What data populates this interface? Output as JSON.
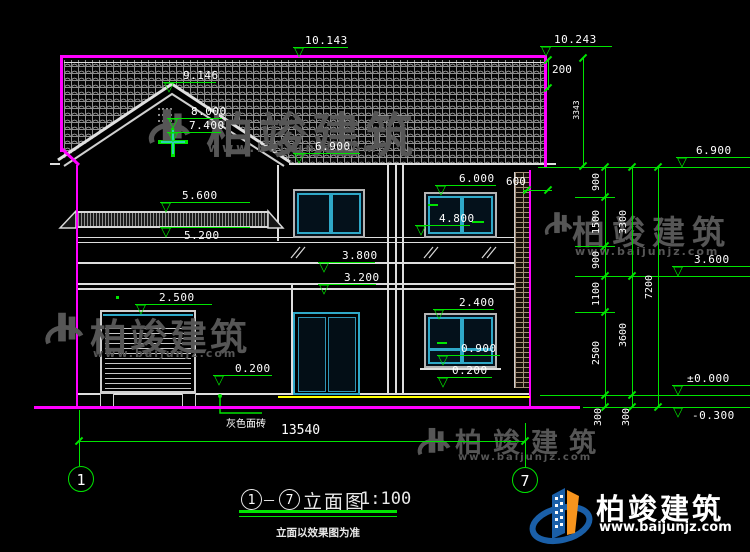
{
  "watermark": {
    "name": "柏竣建筑",
    "url": "www.baijunjz.com"
  },
  "logo": {
    "name": "柏竣建筑",
    "url": "www.baijunjz.com"
  },
  "title": {
    "grid_from": "1",
    "grid_to": "7",
    "separator": "－",
    "name": "立面图",
    "scale": "1:100",
    "note": "立面以效果图为准"
  },
  "grid_bubbles": {
    "left": "1",
    "right": "7"
  },
  "labels": {
    "facade_material": "灰色面砖"
  },
  "symbols": {
    "level_triangle": "▽"
  },
  "levels": {
    "ridge_left": "10.143",
    "ridge_right": "10.243",
    "gable_peak": "9.146",
    "gable_upper": "8.000",
    "gable_cross": "7.400",
    "eave_left": "6.900",
    "eave_right": "6.900",
    "canopy_top": "5.600",
    "canopy_bottom": "5.200",
    "garage_head": "2.500",
    "win2_head": "6.000",
    "win2_sill": "4.800",
    "railing_top": "3.800",
    "floor2": "3.200",
    "win1_head": "2.400",
    "win1_transom": "0.900",
    "win1_sill": "0.200",
    "porch": "0.200",
    "right_3600": "3.600",
    "right_zero": "±0.000",
    "right_minus": "-0.300"
  },
  "dims": {
    "roof_edge": "200",
    "roof_side": "3343",
    "overhang": "600",
    "total_width": "13540",
    "chain_inner": [
      "900",
      "1500",
      "900",
      "1100",
      "2500",
      "300"
    ],
    "chain_mid": [
      "3300",
      "3600",
      "300"
    ],
    "chain_outer": [
      "7200"
    ]
  },
  "colors": {
    "dim_green": "#00e400",
    "magenta": "#ff00ff",
    "frame_cyan": "#2fa8c8",
    "ground_yellow": "#ffff00",
    "watermark_gray": "#565656",
    "logo_blue": "#1a5fa8",
    "logo_orange": "#f7941d"
  }
}
